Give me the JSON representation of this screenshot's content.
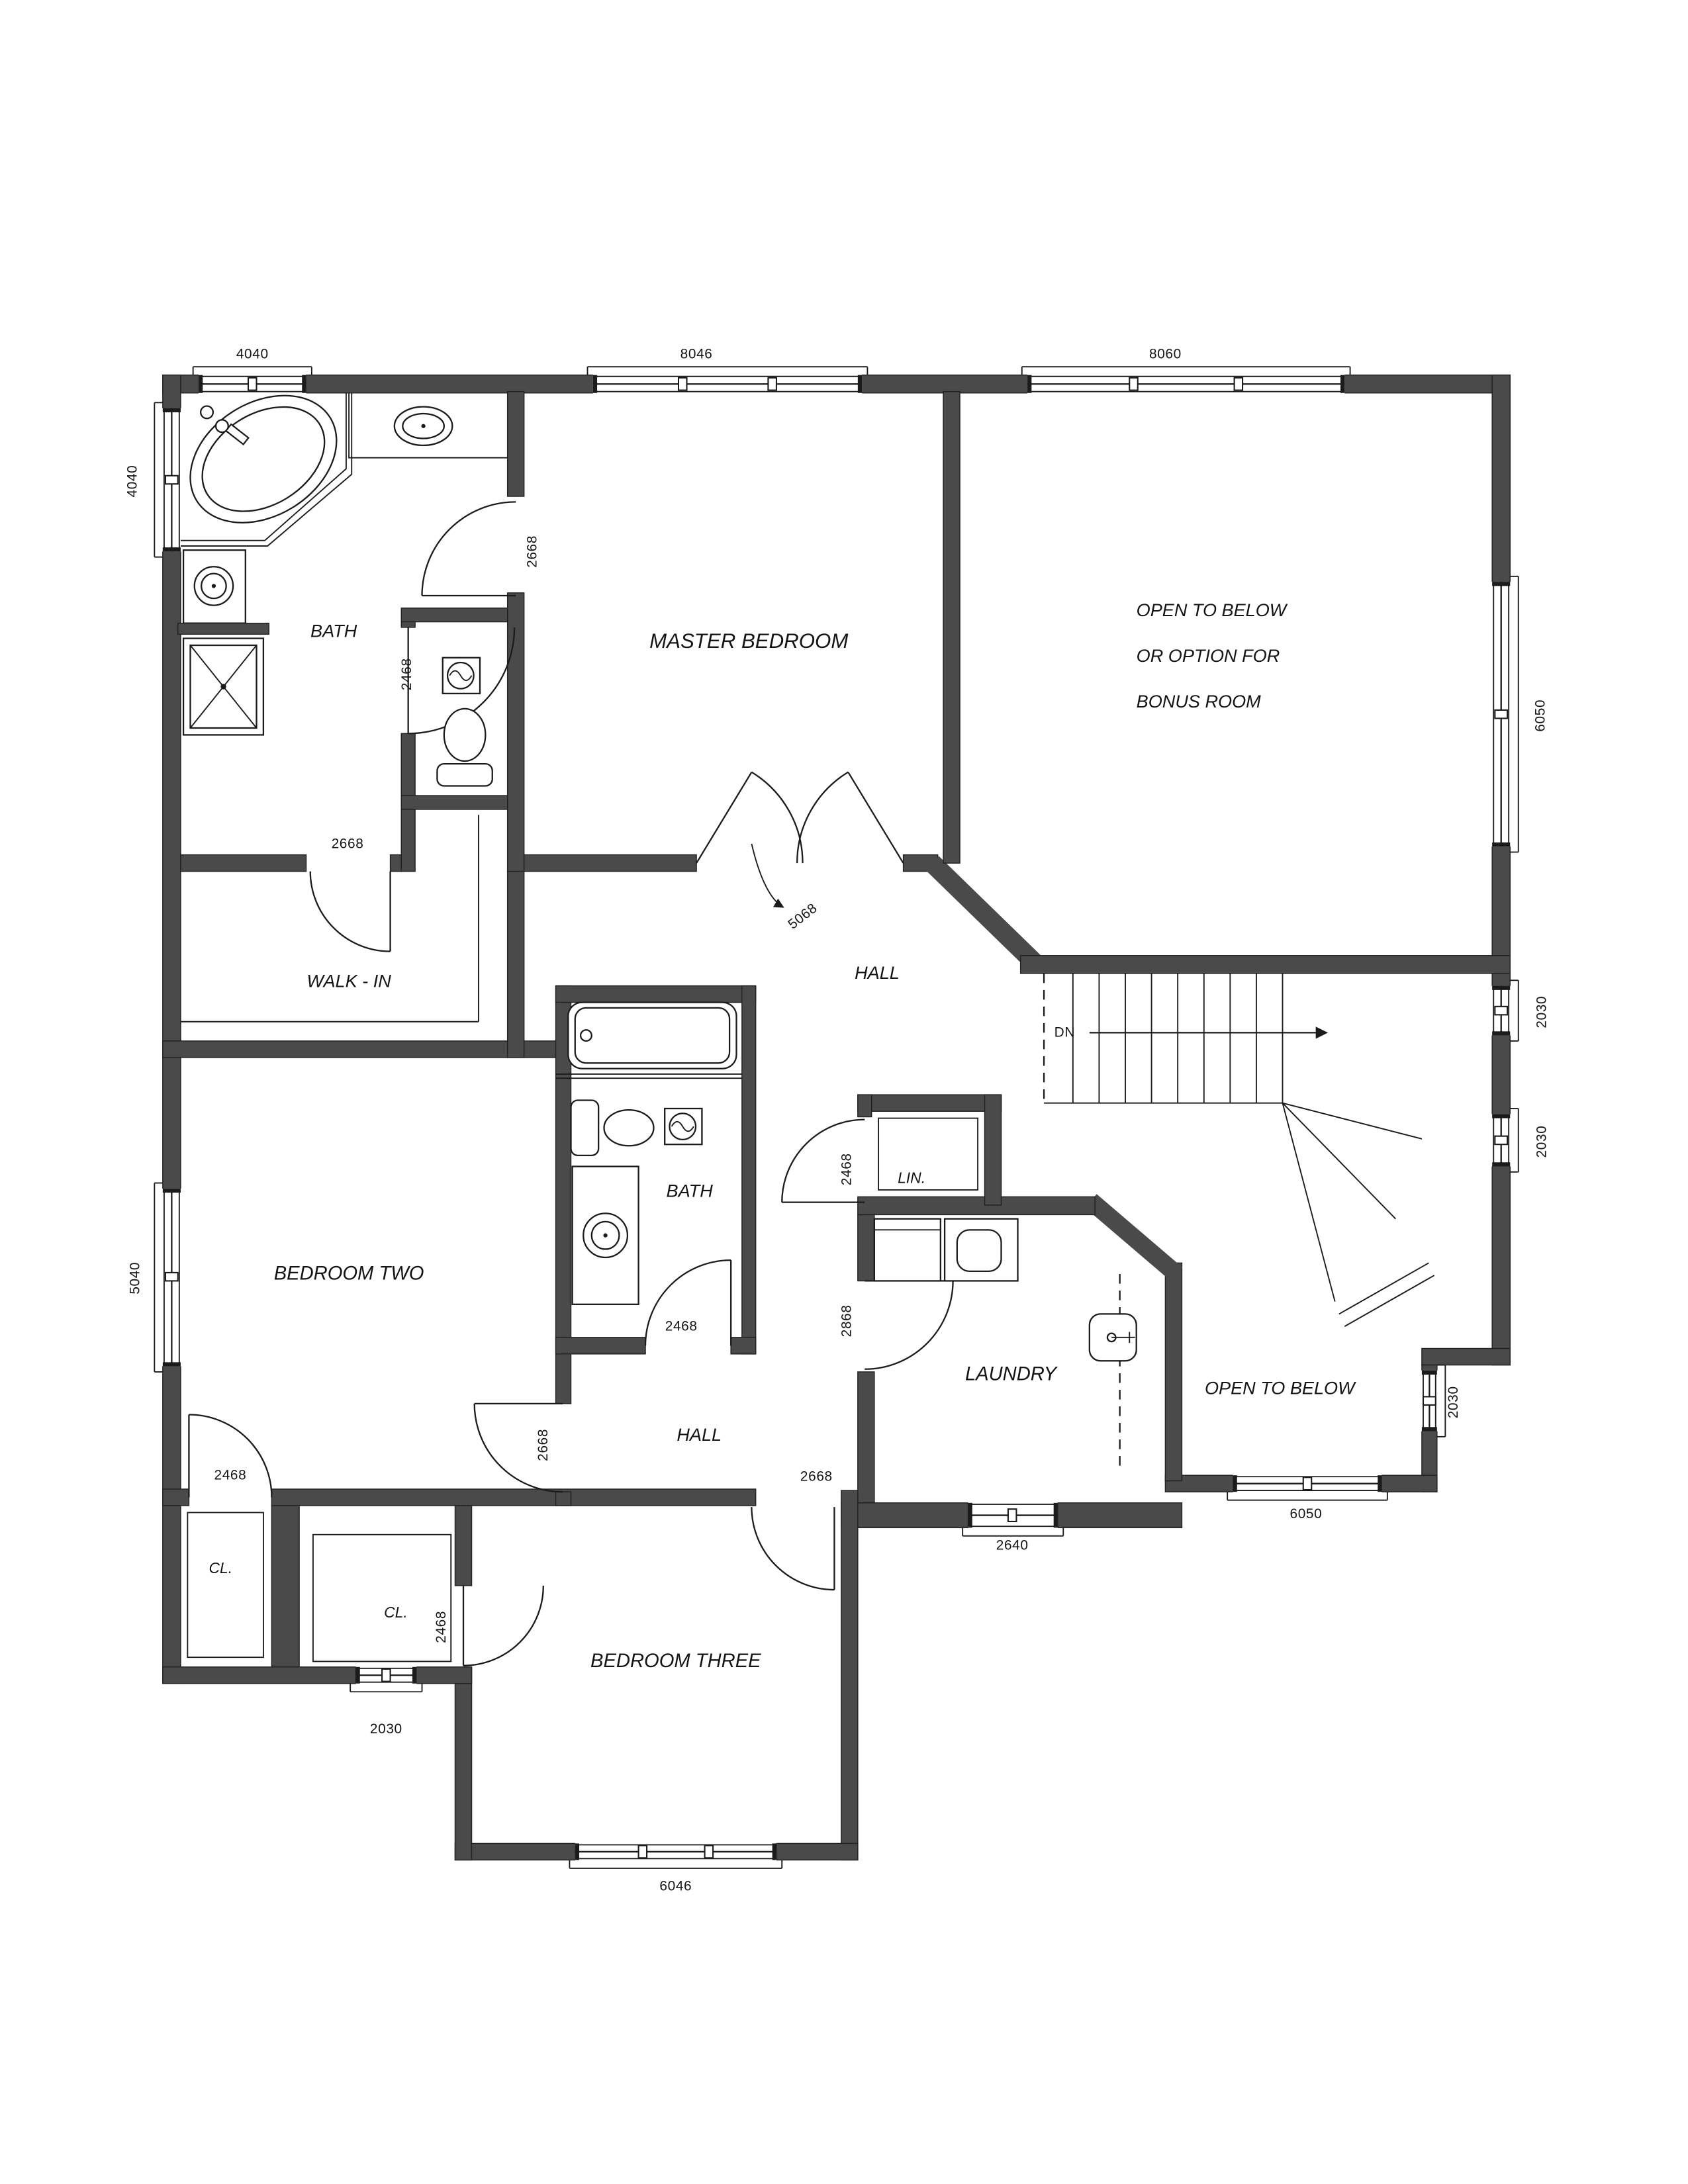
{
  "rooms": {
    "master_bedroom": "MASTER BEDROOM",
    "master_bath": "BATH",
    "walk_in": "WALK - IN",
    "hall_upper": "HALL",
    "hall_lower": "HALL",
    "bedroom_two": "BEDROOM TWO",
    "bedroom_three": "BEDROOM THREE",
    "bath_two": "BATH",
    "linen": "LIN.",
    "laundry": "LAUNDRY",
    "open_to_below": "OPEN TO BELOW",
    "bonus_line1": "OPEN TO BELOW",
    "bonus_line2": "OR OPTION FOR",
    "bonus_line3": "BONUS ROOM",
    "closet_left": "CL.",
    "closet_bedroom_three": "CL.",
    "stairs_down": "DN"
  },
  "dimensions": {
    "top_bath_window": "4040",
    "top_master_window": "8046",
    "top_bonus_window": "8060",
    "left_bath_window": "4040",
    "left_bedroom_two_window": "5040",
    "right_bonus_window": "6050",
    "right_stair_window_upper": "2030",
    "right_stair_window_mid": "2030",
    "right_open_below_window": "2030",
    "bottom_open_below_window": "6050",
    "bottom_laundry_window": "2640",
    "bottom_bedroom_three_window": "6046",
    "bottom_closet_window": "2030"
  },
  "doors": {
    "master_bath_door": "2668",
    "water_closet_door": "2468",
    "walk_in_door": "2668",
    "master_bedroom_door": "5068",
    "bath_two_door": "2468",
    "linen_door": "2468",
    "laundry_door": "2868",
    "bedroom_two_door": "2668",
    "bedroom_three_door": "2668",
    "closet_left_door": "2468",
    "bedroom_three_closet_door": "2468"
  },
  "colors": {
    "wall": "#4a4a4a",
    "line": "#1b1b1b",
    "background": "#ffffff"
  }
}
